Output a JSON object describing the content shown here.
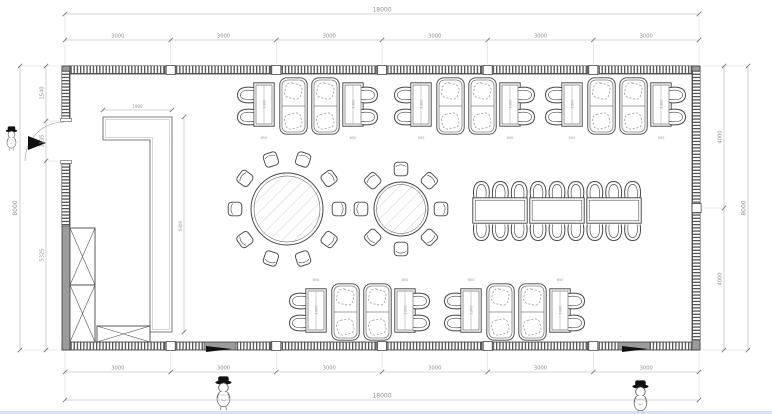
{
  "plan": {
    "dims": {
      "overall_width": "18000",
      "overall_height": "8000",
      "top_segments": [
        "3000",
        "3000",
        "3000",
        "3000",
        "3000",
        "3000"
      ],
      "bottom_segments": [
        "3000",
        "3000",
        "3000",
        "3000",
        "3000",
        "3000"
      ],
      "left_segments": [
        "1540",
        "1135",
        "5325"
      ],
      "right_segments": [
        "4000",
        "4000"
      ],
      "partition_width": "1900",
      "partition_height": "5300",
      "booth_table_width": "650",
      "booth_table_length": "1300"
    },
    "colors": {
      "wall": "#9c9c9c",
      "line": "#474747",
      "dim_line": "#aaaaaa",
      "dim_text": "#8f8f8f",
      "footer_strip": "#ccdcef"
    },
    "icons": {
      "entry_arrow": "solid-door-direction-arrow",
      "mascot": "cartoon-figure-with-black-hat"
    }
  }
}
